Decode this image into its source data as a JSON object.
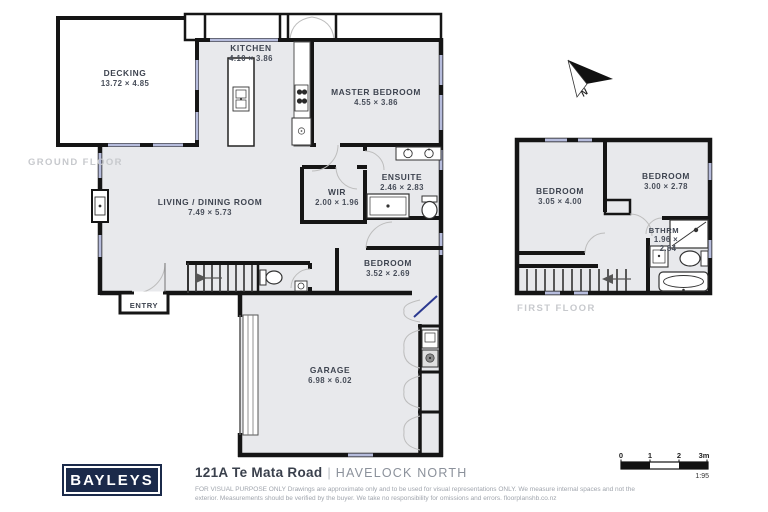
{
  "page": {
    "brand": "BAYLEYS",
    "address": "121A Te Mata Road",
    "separator": "|",
    "suburb": "HAVELOCK NORTH",
    "disclaimer1": "FOR VISUAL PURPOSE ONLY Drawings are approximate only and to be used for visual representations ONLY. We measure internal spaces and not the",
    "disclaimer2": "exterior. Measurements should be verified by the buyer. We take no responsibility for omissions and errors. floorplanshb.co.nz"
  },
  "colors": {
    "brand_navy": "#1b2a4a",
    "wall": "#151515",
    "floor_fill": "#e8e9ec",
    "window": "#b6bcdc",
    "door_accent": "#2b3990"
  },
  "floors": {
    "ground": {
      "label": "GROUND FLOOR",
      "rooms": {
        "decking": {
          "name": "DECKING",
          "dims": "13.72 × 4.85"
        },
        "kitchen": {
          "name": "KITCHEN",
          "dims": "4.10 × 3.86"
        },
        "master": {
          "name": "MASTER BEDROOM",
          "dims": "4.55 × 3.86"
        },
        "wir": {
          "name": "WIR",
          "dims": "2.00 × 1.96"
        },
        "ensuite": {
          "name": "ENSUITE",
          "dims": "2.46 × 2.83"
        },
        "living": {
          "name": "LIVING / DINING ROOM",
          "dims": "7.49 × 5.73"
        },
        "bedroom": {
          "name": "BEDROOM",
          "dims": "3.52 × 2.69"
        },
        "entry": {
          "name": "ENTRY"
        },
        "garage": {
          "name": "GARAGE",
          "dims": "6.98 × 6.02"
        }
      }
    },
    "first": {
      "label": "FIRST FLOOR",
      "rooms": {
        "bedroom1": {
          "name": "BEDROOM",
          "dims": "3.05 × 4.00"
        },
        "bedroom2": {
          "name": "BEDROOM",
          "dims": "3.00 × 2.78"
        },
        "bathroom": {
          "name": "BTHRM",
          "dims_a": "1.96 ×",
          "dims_b": "2.84"
        }
      }
    }
  },
  "compass": {
    "label": "N"
  },
  "scale_bar": {
    "ticks": [
      "0",
      "1",
      "2",
      "3m"
    ],
    "ratio": "1:95"
  }
}
